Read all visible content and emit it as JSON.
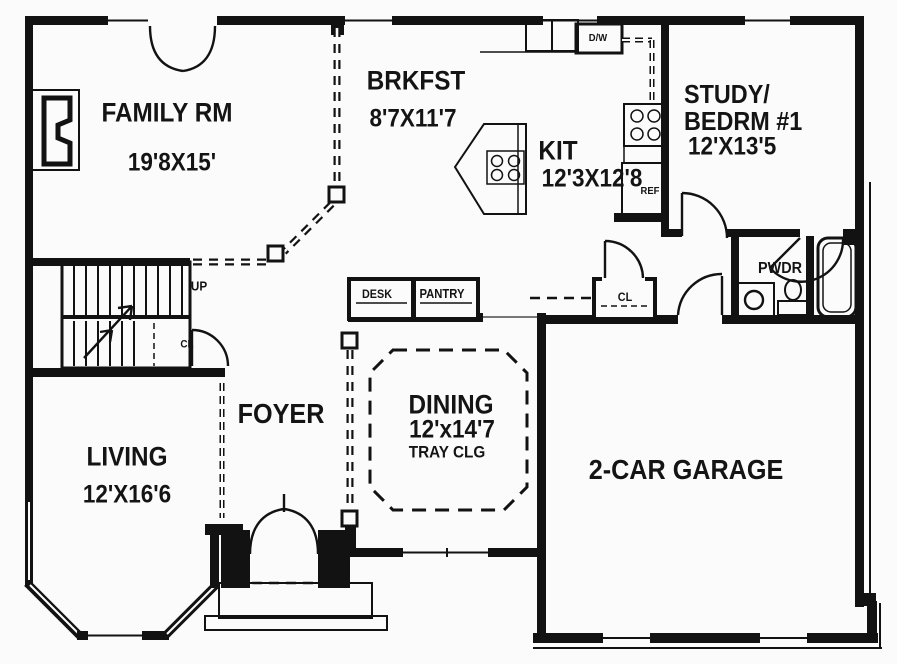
{
  "rooms": {
    "family": {
      "label": "FAMILY RM",
      "dims": "19'8X15'"
    },
    "brkfst": {
      "label": "BRKFST",
      "dims": "8'7X11'7"
    },
    "kitchen": {
      "label": "KIT",
      "dims": "12'3X12'8"
    },
    "study": {
      "label_line1": "STUDY/",
      "label_line2": "BEDRM #1",
      "dims": "12'X13'5"
    },
    "powder": {
      "label": "PWDR"
    },
    "foyer": {
      "label": "FOYER"
    },
    "dining": {
      "label": "DINING",
      "dims": "12'x14'7",
      "ceiling_note": "TRAY CLG"
    },
    "living": {
      "label": "LIVING",
      "dims": "12'X16'6"
    },
    "garage": {
      "label": "2-CAR GARAGE"
    }
  },
  "annotations": {
    "stairs_direction": "UP",
    "stair_closet": "CL",
    "hall_closet": "CL",
    "desk": "DESK",
    "pantry": "PANTRY",
    "dishwasher": "D/W",
    "refrigerator": "REF"
  },
  "colors": {
    "line": "#121212",
    "background": "#fbfbfb"
  }
}
